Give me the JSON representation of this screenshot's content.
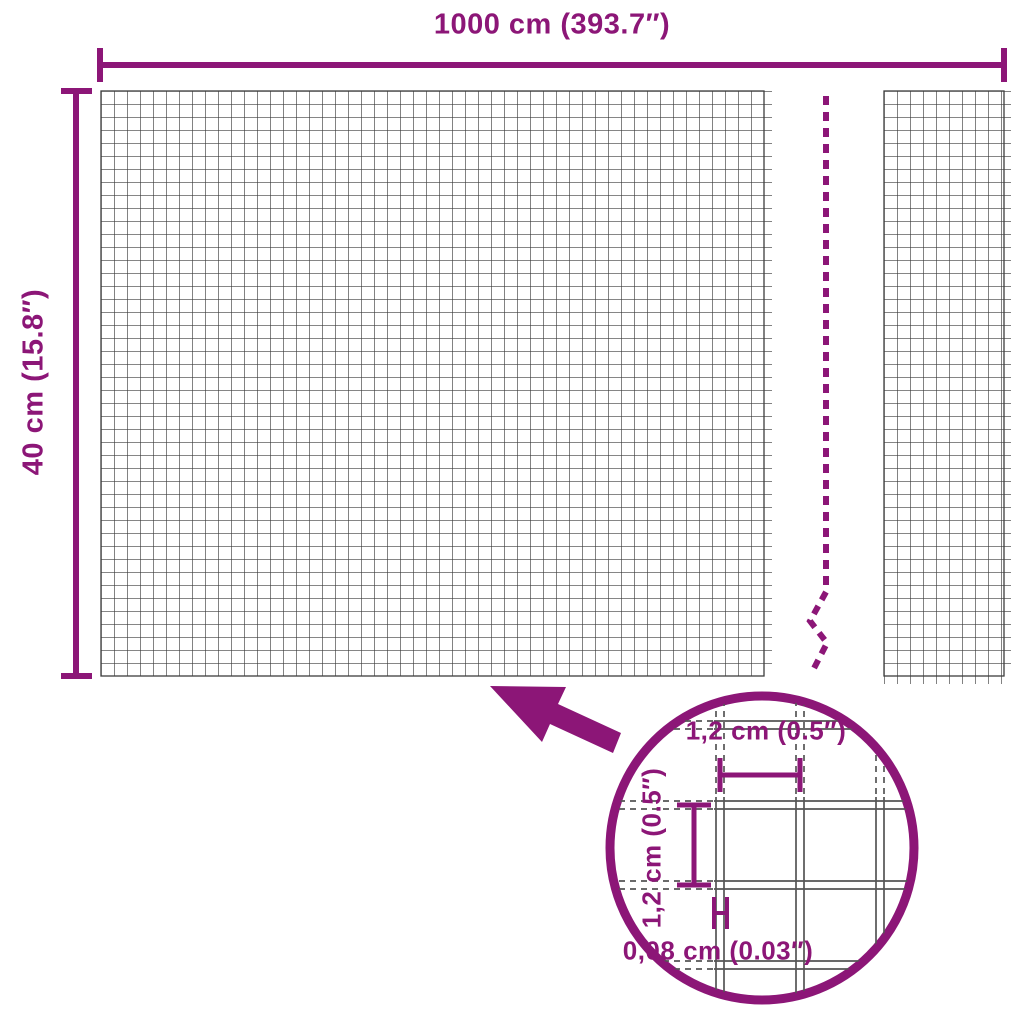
{
  "colors": {
    "accent": "#8C1677",
    "mesh_line": "#3d3d3d",
    "lens_wire": "#555555"
  },
  "dimensions": {
    "width_label": "1000 cm (393.7″)",
    "height_label": "40 cm (15.8″)"
  },
  "lens": {
    "cell_width_label": "1,2 cm (0.5″)",
    "cell_height_label": "1,2 cm (0.5″)",
    "wire_thickness_label": "0,08 cm (0.03″)"
  }
}
